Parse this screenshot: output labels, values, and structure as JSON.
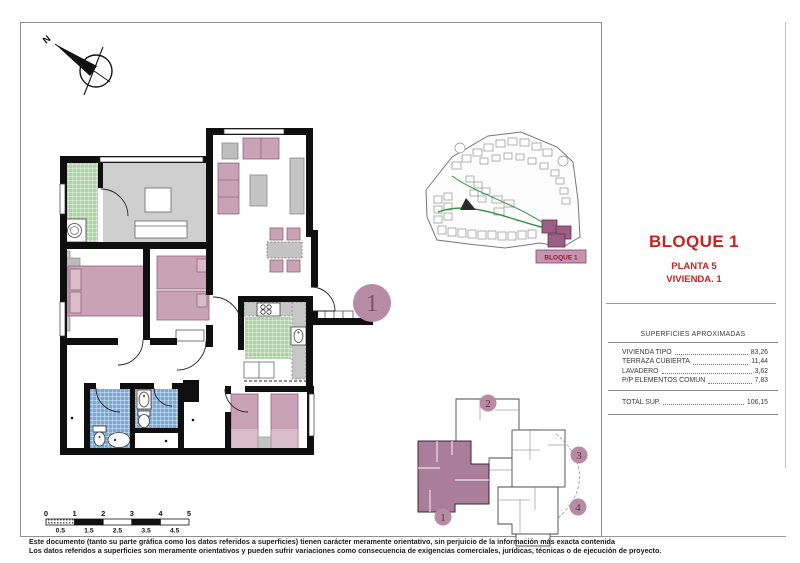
{
  "compass": {
    "north": "N"
  },
  "title_block": {
    "block": "BLOQUE 1",
    "floor": "PLANTA 5",
    "unit": "VIVIENDA. 1"
  },
  "areas_table": {
    "header": "SUPERFICIES APROXIMADAS",
    "rows": [
      {
        "label": "VIVIENDA TIPO",
        "value": "83,26"
      },
      {
        "label": "TERRAZA CUBIERTA",
        "value": "11,44"
      },
      {
        "label": "LAVADERO",
        "value": "3,62"
      },
      {
        "label": "P/P ELEMENTOS COMUN",
        "value": "7,83"
      }
    ],
    "total": {
      "label": "TOTAL SUP.",
      "value": "106,15"
    }
  },
  "floor_plan": {
    "unit_marker": "1"
  },
  "site_plan": {
    "block_label": "BLOQUE 1"
  },
  "key_plan": {
    "markers": [
      "2",
      "3",
      "4",
      "1"
    ]
  },
  "scale_bar": {
    "major": [
      "0",
      "1",
      "2",
      "3",
      "4",
      "5"
    ],
    "minor": [
      "0.5",
      "1.5",
      "2.5",
      "3.5",
      "4.5"
    ]
  },
  "disclaimer": {
    "line1": "Este documento (tanto su parte gráfica como los datos referidos a superficies) tienen carácter meramente orientativo, sin perjuicio de la información más exacta contenida",
    "line2": "Los datos referidos a superficies son meramente orientativos y pueden sufrir variaciones como consecuencia de exigencias comerciales, jurídicas, técnicas o de ejecución de proyecto."
  },
  "colors": {
    "accent_red": "#cc2020",
    "highlight_mauve": "#b78ba4",
    "site_highlight": "#9a5f84",
    "tile_green": "#abd4a4",
    "tile_blue": "#76a9dd",
    "floor_gray": "#cfcfcf",
    "furniture_pink": "#c9a2b6"
  }
}
